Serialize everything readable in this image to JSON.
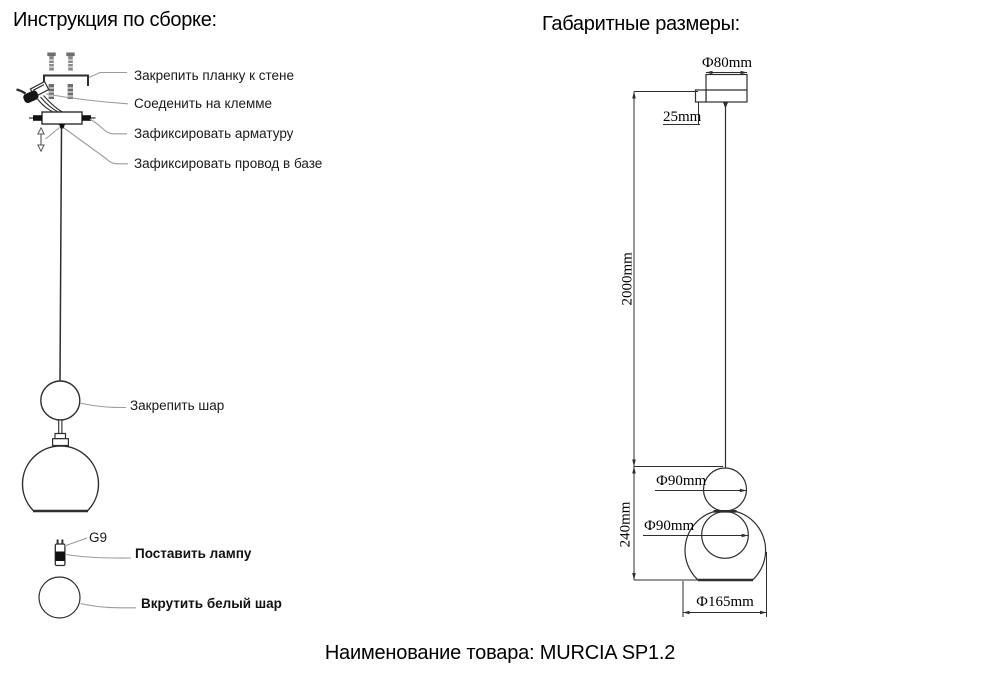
{
  "left": {
    "title": "Инструкция по сборке:",
    "labels": {
      "attach_bar": "Закрепить планку к стене",
      "connect_terminal": "Соеденить на клемме",
      "fix_fixture": "Зафиксировать арматуру",
      "fix_wire_base": "Зафиксировать провод в базе",
      "fix_ball": "Закрепить шар",
      "socket_type": "G9",
      "install_lamp": "Поставить лампу",
      "screw_white_ball": "Вкрутить белый шар"
    }
  },
  "right": {
    "title": "Габаритные размеры:",
    "dims": {
      "canopy_diameter": "Ф80mm",
      "canopy_offset": "25mm",
      "cord_length": "2000mm",
      "fixture_height": "240mm",
      "top_ball_diameter": "Ф90mm",
      "inner_ball_diameter": "Ф90mm",
      "shade_diameter": "Ф165mm"
    }
  },
  "footer": {
    "product_name": "Наименование товара: MURCIA SP1.2"
  },
  "colors": {
    "line": "#2e2e2e",
    "leader": "#9b9b9b",
    "text": "#000000",
    "background": "#ffffff"
  }
}
